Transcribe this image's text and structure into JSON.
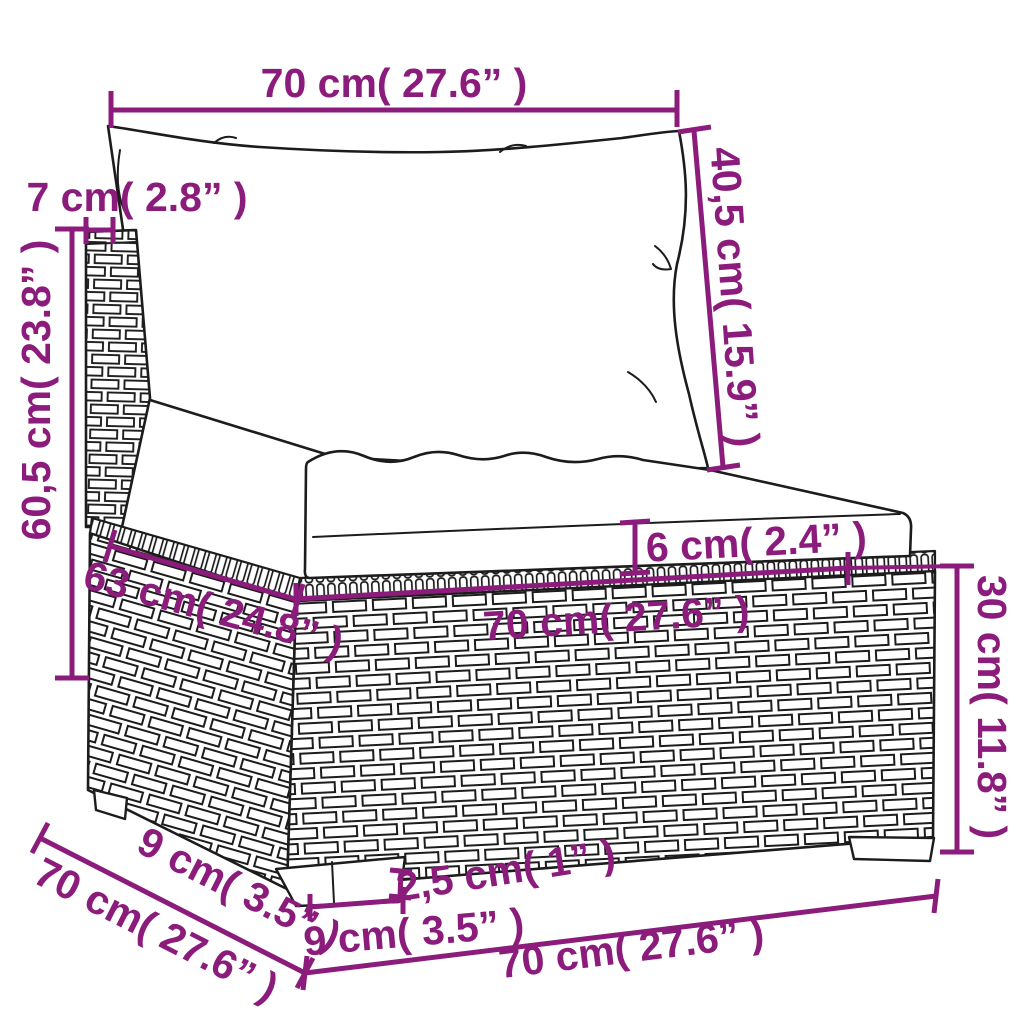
{
  "meta": {
    "subject": "poly rattan sofa middle section dimension diagram",
    "accent_color": "#8B1C7C",
    "line_color": "#1c1c1c",
    "background_color": "#ffffff"
  },
  "dims": {
    "back_width": "70 cm( 27.6” )",
    "back_cushion_height": "40,5 cm( 15.9” )",
    "back_thickness": "7 cm( 2.8” )",
    "total_height": "60,5 cm( 23.8” )",
    "seat_depth": "63 cm( 24.8” )",
    "seat_cushion_thickness": "6 cm( 2.4” )",
    "seat_width": "70 cm( 27.6” )",
    "base_height": "30 cm( 11.8” )",
    "leg_inset": "9 cm( 3.5” )",
    "depth": "70 cm( 27.6” )",
    "leg_height": "2,5 cm( 1” )",
    "leg_width": "9 cm( 3.5” )",
    "bottom_width": "70 cm( 27.6” )"
  }
}
